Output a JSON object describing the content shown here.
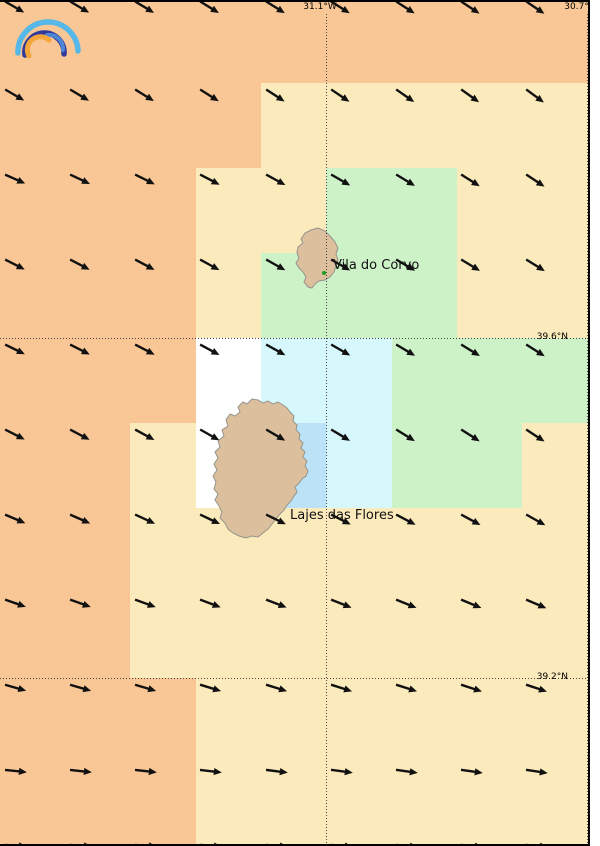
{
  "map": {
    "width": 590,
    "height": 846,
    "palette": {
      "O": "#F9C795",
      "C": "#FBEABB",
      "G": "#CDF2C8",
      "Y": "#D6F8FC",
      "B": "#BCE2F7",
      "W": "#FFFFFF"
    },
    "grid": {
      "xs": [
        0,
        65,
        130,
        196,
        261,
        326,
        392,
        457,
        522,
        590
      ],
      "ys": [
        0,
        83,
        168,
        253,
        338,
        423,
        508,
        593,
        678,
        763,
        846
      ],
      "cells": [
        "OOOOOOOOO",
        "OOOOCCCCC",
        "OOOCCGGCC",
        "OOOCGGGCC",
        "OOOWYYGGG",
        "OOCWBYGGC",
        "OOCCCCCCC",
        "OOCCCCCCC",
        "OOOCCCCCC",
        "OOOCCCCCC"
      ]
    },
    "gridlines": {
      "color": "#444444",
      "meridians": [
        {
          "label": "31.1°W",
          "x": 326
        },
        {
          "label": "30.7°W",
          "x": 587
        }
      ],
      "parallels": [
        {
          "label": "39.6°N",
          "y": 338
        },
        {
          "label": "39.2°N",
          "y": 678
        }
      ]
    },
    "wind": {
      "color": "#111111",
      "cols": [
        6,
        71,
        136,
        201,
        267,
        332,
        397,
        462,
        527,
        592
      ],
      "rows": [
        {
          "y": 2,
          "base": 30,
          "colDelta": 0.5
        },
        {
          "y": 90,
          "base": 30,
          "colDelta": 0.8
        },
        {
          "y": 175,
          "base": 24,
          "colDelta": 1.2
        },
        {
          "y": 260,
          "base": 27,
          "colDelta": 0.6
        },
        {
          "y": 345,
          "base": 26,
          "colDelta": 0.8
        },
        {
          "y": 430,
          "base": 27,
          "colDelta": 0.8
        },
        {
          "y": 515,
          "base": 23,
          "colDelta": 0.8
        },
        {
          "y": 600,
          "base": 19,
          "colDelta": 0.5
        },
        {
          "y": 685,
          "base": 16,
          "colDelta": 0.3
        },
        {
          "y": 770,
          "base": 6,
          "colDelta": 0.3
        },
        {
          "y": 845,
          "base": 4,
          "colDelta": 0.2
        }
      ]
    },
    "places": [
      {
        "name": "Vila do Corvo",
        "dot_x": 324,
        "dot_y": 273,
        "label_x": 333,
        "label_y": 265
      },
      {
        "name": "Lajes das Flores",
        "dot_x": 281,
        "dot_y": 522,
        "label_x": 290,
        "label_y": 515
      }
    ],
    "islands": {
      "fill": "#DCC09E",
      "stroke": "#94938B"
    },
    "marker_color": "#1E9C1E",
    "border_color": "#000000"
  },
  "logo": {
    "name": "open-meteo-rainbow-logo",
    "colors": {
      "outer": "#55B8E8",
      "dark": "#31399B",
      "mid": "#4E86D6",
      "inner": "#F4A63B"
    }
  }
}
